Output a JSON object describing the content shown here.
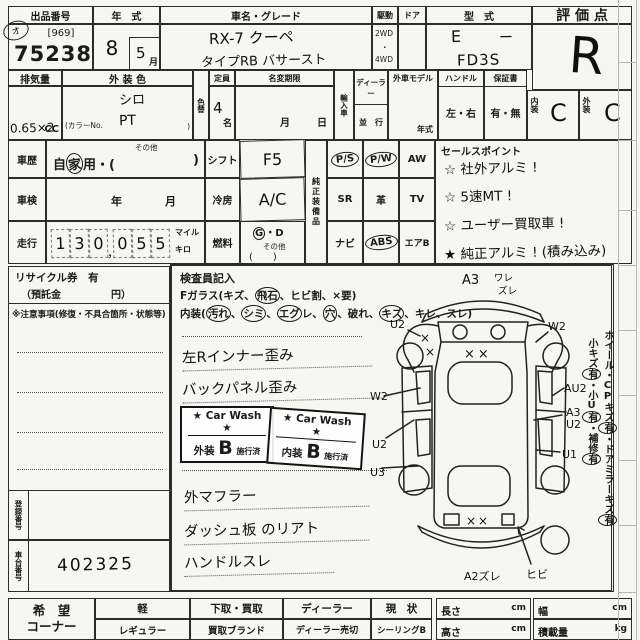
{
  "header": {
    "auction_label": "出品番号",
    "auction_bracket": "[969]",
    "auction_no": "75238",
    "corner_mark": "オ",
    "year_label": "年　式",
    "year_value": "8",
    "month_value": "5",
    "month_unit": "月",
    "car_label": "車名・グレード",
    "car_line1": "RX-7 クーペ",
    "car_line2": "タイプRB バサースト",
    "drive_label": "駆動",
    "drive_2wd": "2WD",
    "drive_dot": "・",
    "drive_4wd": "4WD",
    "door_label": "ドア",
    "model_label": "型　式",
    "model_e": "E",
    "model_dash": "ー",
    "model_fd": "FD3S",
    "score_label": "評 価 点",
    "score_value": "R"
  },
  "row2": {
    "disp_label": "排気量",
    "disp_value": "0.65×2",
    "disp_unit": "CC",
    "color_label": "外 装 色",
    "color_prefix": "(カラーNo.",
    "color_suffix": ")",
    "color_line1": "シロ",
    "color_line2": "PT",
    "colorchg_label": "色替",
    "cap_label": "定員",
    "cap_value": "4",
    "cap_unit": "名",
    "namechg_label": "名変期限",
    "nm_month": "月",
    "nm_day": "日",
    "import_label": "輸入車",
    "dealer_label": "ディーラー",
    "parallel_label": "並　行",
    "foreign_label": "外車モデル",
    "foreign_year": "年式",
    "handle_label": "ハンドル",
    "handle_opts": "左・右",
    "warranty_label": "保証書",
    "warranty_opts": "有・無",
    "interior_label": "内装",
    "interior_value": "C",
    "exterior_label": "外装",
    "exterior_value": "C"
  },
  "mid": {
    "history_label": "車歴",
    "history_other": "その他",
    "history_pre": "自",
    "history_circ": "家",
    "history_post": "用・(",
    "history_close": ")",
    "shaken_label": "車検",
    "shaken_year": "年",
    "shaken_month": "月",
    "mileage_label": "走行",
    "digits": [
      "1",
      "3",
      "0",
      "0",
      "5",
      "5"
    ],
    "comma": "，",
    "unit_mile": "マイル",
    "unit_km": "キロ",
    "shift_label": "シフト",
    "shift_value": "F5",
    "ac_label": "冷房",
    "ac_value": "A/C",
    "fuel_label": "燃料",
    "fuel_g": "G",
    "fuel_rest": "・D",
    "fuel_other": "その他",
    "fuel_paren": "(　　)",
    "equip_label": "純正装備品",
    "equipment": [
      {
        "label": "P/S",
        "circled": true
      },
      {
        "label": "P/W",
        "circled": true
      },
      {
        "label": "AW",
        "circled": false
      },
      {
        "label": "SR",
        "circled": false
      },
      {
        "label": "革",
        "circled": false
      },
      {
        "label": "TV",
        "circled": false
      },
      {
        "label": "ナビ",
        "circled": false
      },
      {
        "label": "ABS",
        "circled": true
      },
      {
        "label": "エアB",
        "circled": false
      }
    ],
    "sales_label": "セールスポイント",
    "sales": [
      "☆ 社外アルミ !",
      "☆ 5速MT !",
      "☆ ユーザー買取車 !",
      "★ 純正アルミ ! (積み込み)"
    ]
  },
  "left_panel": {
    "recycle_line1": "リサイクル券　有",
    "recycle_line2": "（預託金　　　　　円）",
    "caution": "※注意事項(修復・不具合箇所・状態等)",
    "regno_label": "登録番号",
    "chassis_label": "車台番号",
    "chassis_value": "402325"
  },
  "inspector": {
    "title": "検査員記入",
    "glass_parts": [
      "Fガラス(キズ、",
      "飛石",
      "、ヒビ割、×要)"
    ],
    "interior_parts": [
      "内装(",
      "汚れ",
      "、",
      "シミ",
      "、",
      "エグ",
      "レ、",
      "穴",
      "、破れ、",
      "キズ",
      "、キレ、スレ)"
    ],
    "notes": [
      "左Rインナー歪み",
      "バックパネル歪み",
      "外マフラー",
      "ダッシュ板 のリアト",
      "ハンドルスレ"
    ],
    "stamps": [
      {
        "title": "★ Car Wash ★",
        "area": "外装",
        "grade": "B",
        "status": "施行済"
      },
      {
        "title": "★ Car Wash ★",
        "area": "内装",
        "grade": "B",
        "status": "施行済"
      }
    ]
  },
  "diagram": {
    "a3_front": "A3",
    "ware": "ワレ",
    "zure": "ズレ",
    "u2_front_left": "U2",
    "w2_front_right": "W2",
    "xx": "××",
    "x": "×",
    "w2_left": "W2",
    "u2_left": "U2",
    "u3_left": "U3",
    "au2_right": "AU2",
    "a3_right": "A3",
    "u2_right": "U2",
    "u1_right": "U1",
    "a2zure": "A2ズレ",
    "hibi": "ヒビ",
    "margin1": [
      "ホイール・CPキズ",
      "有",
      "・ドアミラーキズ",
      "有"
    ],
    "margin2": [
      "小キズ",
      "有",
      "・小U",
      "有",
      "・補修",
      "有"
    ]
  },
  "footer": {
    "corner_line1": "希　望",
    "corner_line2": "コーナー",
    "cols": [
      {
        "top": "軽",
        "bottom": "レギュラー"
      },
      {
        "top": "下取・買取",
        "bottom": "買取ブランド"
      },
      {
        "top": "ディーラー",
        "bottom": "ディーラー売切"
      },
      {
        "top": "現　状",
        "bottom": "シーリングB"
      }
    ],
    "length_label": "長さ",
    "length_unit": "cm",
    "width_label": "幅",
    "width_unit": "cm",
    "height_label": "高さ",
    "height_unit": "cm",
    "load_label": "積載量",
    "load_unit": "kg"
  }
}
